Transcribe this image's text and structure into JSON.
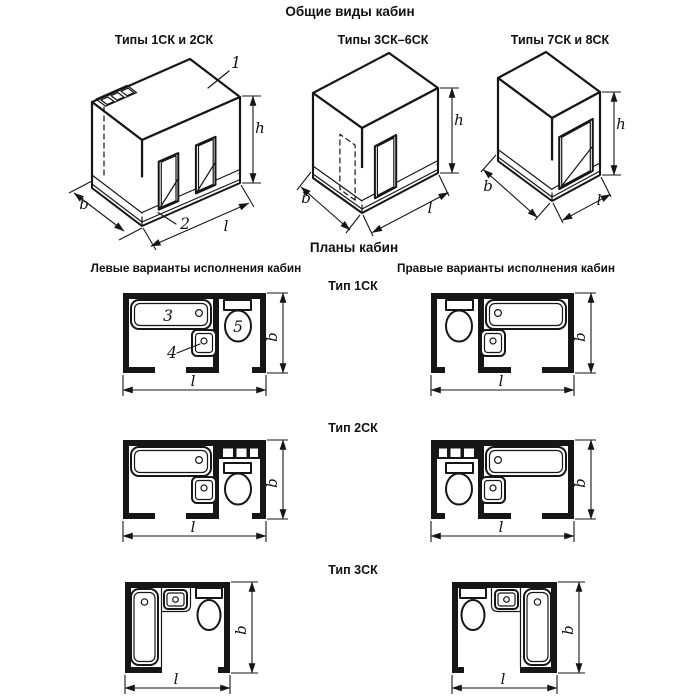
{
  "canvas": {
    "width": 700,
    "height": 700,
    "background": "#ffffff",
    "ink": "#161616"
  },
  "sections": {
    "general_views": {
      "title": "Общие виды кабин",
      "views": [
        {
          "id": "view-1sk-2sk",
          "title": "Типы 1СК и 2СК",
          "callouts": {
            "roof": "1",
            "base": "2"
          }
        },
        {
          "id": "view-3sk-6sk",
          "title": "Типы 3СК–6СК"
        },
        {
          "id": "view-7sk-8sk",
          "title": "Типы 7СК и 8СК"
        }
      ]
    },
    "plans": {
      "title": "Планы кабин",
      "left_heading": "Левые варианты исполнения кабин",
      "right_heading": "Правые варианты исполнения кабин",
      "rows": [
        {
          "label": "Тип 1СК",
          "callouts": {
            "bath": "3",
            "sink": "4",
            "toilet": "5"
          }
        },
        {
          "label": "Тип 2СК"
        },
        {
          "label": "Тип 3СК"
        }
      ]
    }
  },
  "dimensions": {
    "width": "b",
    "length": "l",
    "height": "h"
  }
}
